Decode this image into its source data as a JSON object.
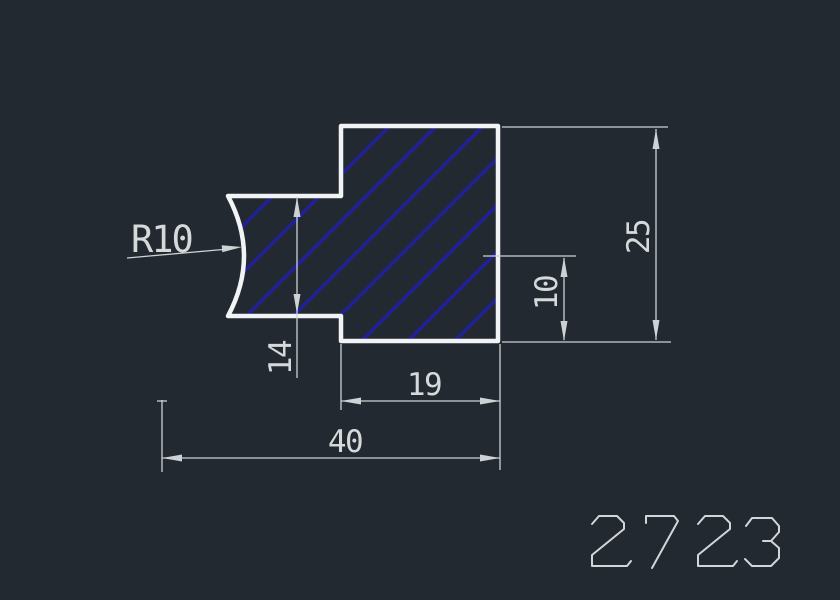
{
  "drawing": {
    "type": "cad-profile-cross-section",
    "hatch_style": "diagonal-45deg",
    "dimensions": {
      "radius_label": "R10",
      "step_height": "14",
      "overall_height": "25",
      "notch_offset": "10",
      "body_width": "19",
      "overall_width": "40"
    },
    "part_number": {
      "value": "2723",
      "strokes": [
        [
          [
            592,
            524
          ],
          [
            599,
            516
          ],
          [
            617,
            516
          ],
          [
            624,
            523
          ],
          [
            624,
            529
          ],
          [
            592,
            555
          ],
          [
            592,
            566
          ],
          [
            627,
            566
          ],
          [
            631,
            561
          ]
        ],
        [
          [
            646,
            523
          ],
          [
            646,
            516
          ],
          [
            674,
            516
          ],
          [
            678,
            521
          ],
          [
            652,
            568
          ]
        ],
        [
          [
            698,
            524
          ],
          [
            705,
            516
          ],
          [
            723,
            516
          ],
          [
            730,
            523
          ],
          [
            730,
            529
          ],
          [
            698,
            555
          ],
          [
            698,
            566
          ],
          [
            733,
            566
          ],
          [
            737,
            561
          ]
        ],
        [
          [
            746,
            526
          ],
          [
            752,
            518
          ],
          [
            772,
            518
          ],
          [
            779,
            526
          ],
          [
            779,
            532
          ],
          [
            771,
            541
          ],
          [
            763,
            541
          ]
        ],
        [
          [
            771,
            541
          ],
          [
            779,
            548
          ],
          [
            779,
            558
          ],
          [
            771,
            566
          ],
          [
            752,
            566
          ],
          [
            745,
            559
          ]
        ]
      ]
    },
    "colors": {
      "background": "#232930",
      "outline": "#f2f3f5",
      "hatch": "#20209d",
      "dimension_lines": "#ced2d5",
      "dimension_text": "#d6d9da",
      "part_number": "#d3d5d7"
    }
  }
}
